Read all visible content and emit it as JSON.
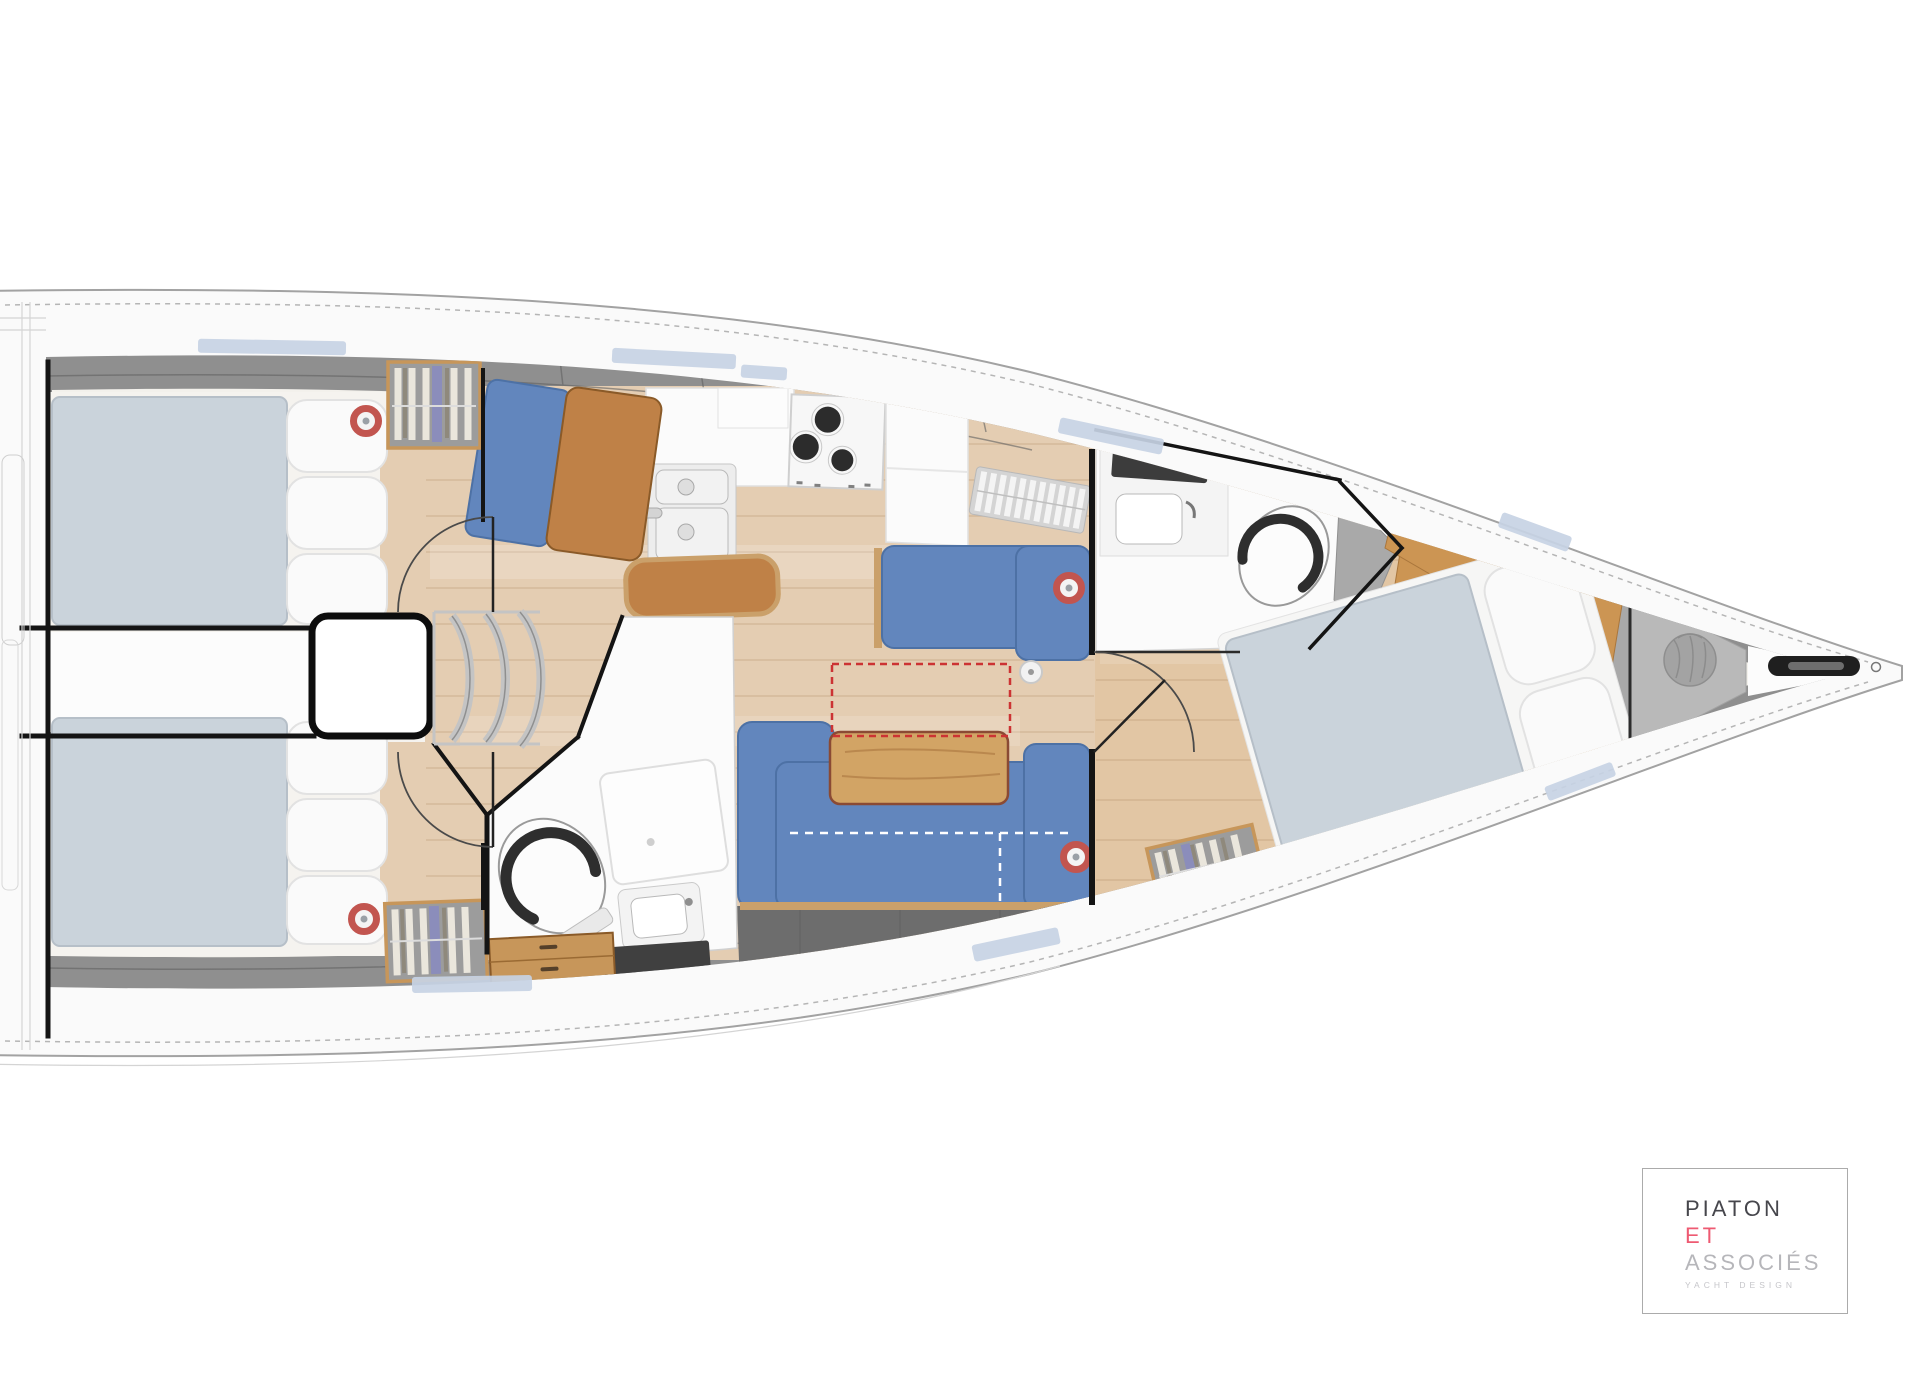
{
  "page": {
    "background": "#ffffff"
  },
  "logo": {
    "line1": "PIATON",
    "line2": "ET",
    "line3": "ASSOCIÉS",
    "tagline": "YACHT DESIGN"
  },
  "plan": {
    "subject": "Sailing yacht interior deck plan, top view, bow to the right",
    "rooms": [
      "aft cabin port",
      "aft cabin starboard",
      "engine box and companionway",
      "galley",
      "navigation seat",
      "salon",
      "aft head",
      "forward head",
      "forward cabin",
      "bow sail locker"
    ],
    "equipment": [
      "double berth x3",
      "L-shaped salon sofas",
      "salon table with folding extension (red dashed)",
      "3-burner stove",
      "double sink",
      "toilet x2",
      "shower x2",
      "hanging locker x3",
      "drawer chest",
      "companionway steps",
      "ceiling speakers x4",
      "anchor roller / bowsprit",
      "sail bag"
    ]
  },
  "colors": {
    "hull": "#fafafa",
    "outline": "#a2a2a2",
    "liner": "#8f8f8f",
    "base": "#f3f1ec",
    "floor": "#e4cdb2",
    "floor_fwd": "#e2c6a4",
    "sofa": "#6286bd",
    "sofa_edge": "#4d71a5",
    "mattress": "#cad3db",
    "pillow": "#fafafa",
    "table_wood": "#d2a465",
    "leather": "#bf8147",
    "cabinet_wood": "#c7965a",
    "wood_trim": "#8a5a28",
    "wood_panel": "#cc9553",
    "dark_storage": "#6d6d6d",
    "gray_seat": "#a9a9a9",
    "speaker": "#c2554f",
    "accent_red": "#cc3333",
    "window": "#c7d3e4",
    "chrome": "#c4c4c4",
    "wall": "#141414",
    "white": "#fbfbfb",
    "bow_gray": "#b9b9b9",
    "bag": "#a3a3a3",
    "logo_dark": "#46464c",
    "logo_pink": "#ee5a72",
    "logo_gray": "#b6b6ba",
    "logo_tag": "#c6c6ca",
    "logo_border": "#ababab"
  }
}
